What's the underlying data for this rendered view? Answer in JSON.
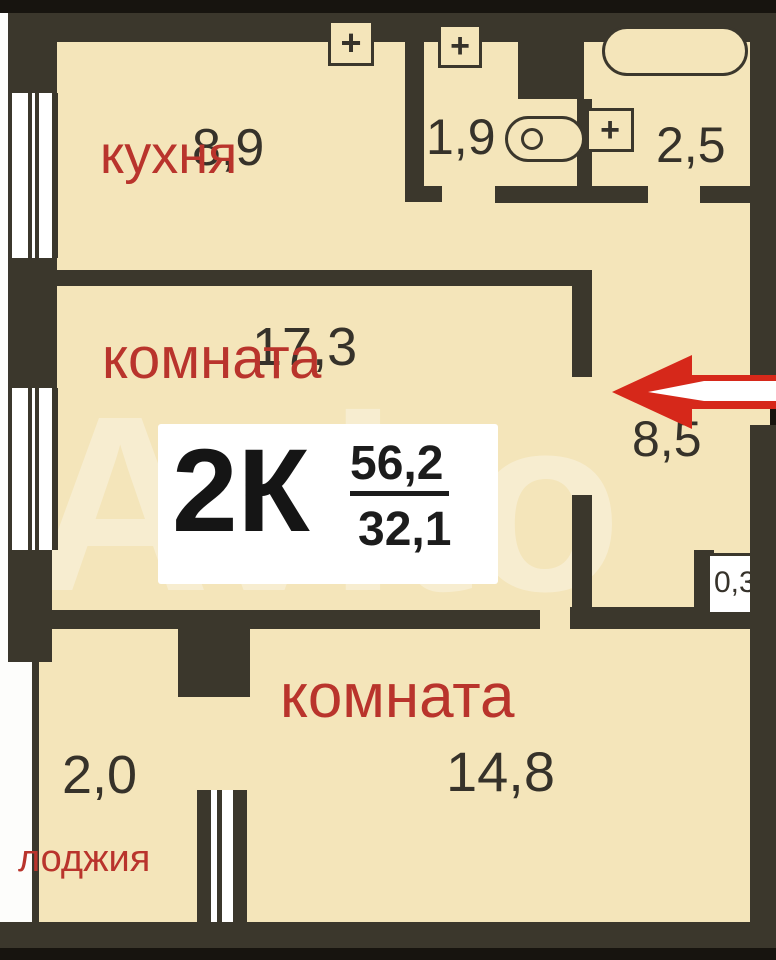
{
  "plan": {
    "watermark": "Avito",
    "info_box": {
      "type_label": "2К",
      "total_area": "56,2",
      "living_area": "32,1"
    },
    "rooms": {
      "kitchen": {
        "name": "кухня",
        "area": "8,9"
      },
      "room1": {
        "name": "комната",
        "area": "17,3"
      },
      "room2": {
        "name": "комната",
        "area": "14,8"
      },
      "loggia": {
        "name": "лоджия",
        "area": "2,0"
      },
      "wc": {
        "area": "1,9"
      },
      "bathroom": {
        "area": "2,5"
      },
      "hallway": {
        "area": "8,5"
      },
      "closet": {
        "area": "0,3"
      }
    },
    "symbols": {
      "plus_glyph": "+"
    },
    "colors": {
      "room_fill": "#f4e5ba",
      "wall": "#3b372c",
      "label_red": "#b9342c",
      "number_dark": "#36322a",
      "arrow_red": "#d6281a",
      "info_box_bg": "#ffffff"
    }
  }
}
